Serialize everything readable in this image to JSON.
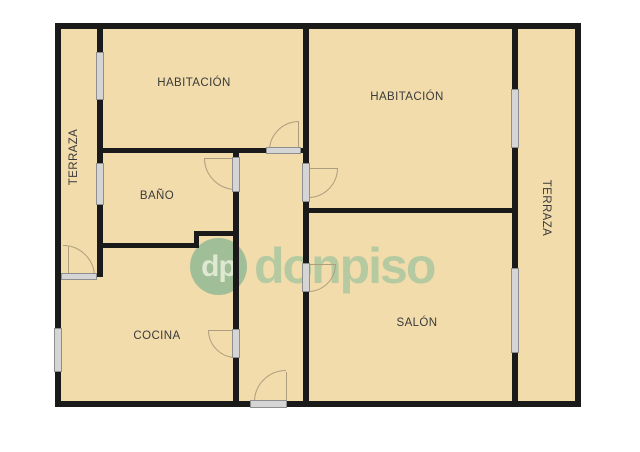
{
  "plan": {
    "type": "apartment-floor-plan"
  },
  "rooms": {
    "habitacion_1": {
      "label": "HABITACIÓN"
    },
    "habitacion_2": {
      "label": "HABITACIÓN"
    },
    "bano": {
      "label": "BAÑO"
    },
    "cocina": {
      "label": "COCINA"
    },
    "salon": {
      "label": "SALÓN"
    },
    "terraza_izquierda": {
      "label": "TERRAZA"
    },
    "terraza_derecha": {
      "label": "TERRAZA"
    }
  },
  "watermark": {
    "logo_initials": "dp",
    "brand": "donpiso"
  },
  "colors": {
    "floor_fill": "#F2DCAB",
    "wall": "#1A1A1A",
    "window_marker": "#D5D5D5",
    "door_arc": "#AD9F7E",
    "watermark_green": "#A0BE97",
    "brand_green": "#B6CAA2",
    "label_text": "#3A3A3A"
  }
}
